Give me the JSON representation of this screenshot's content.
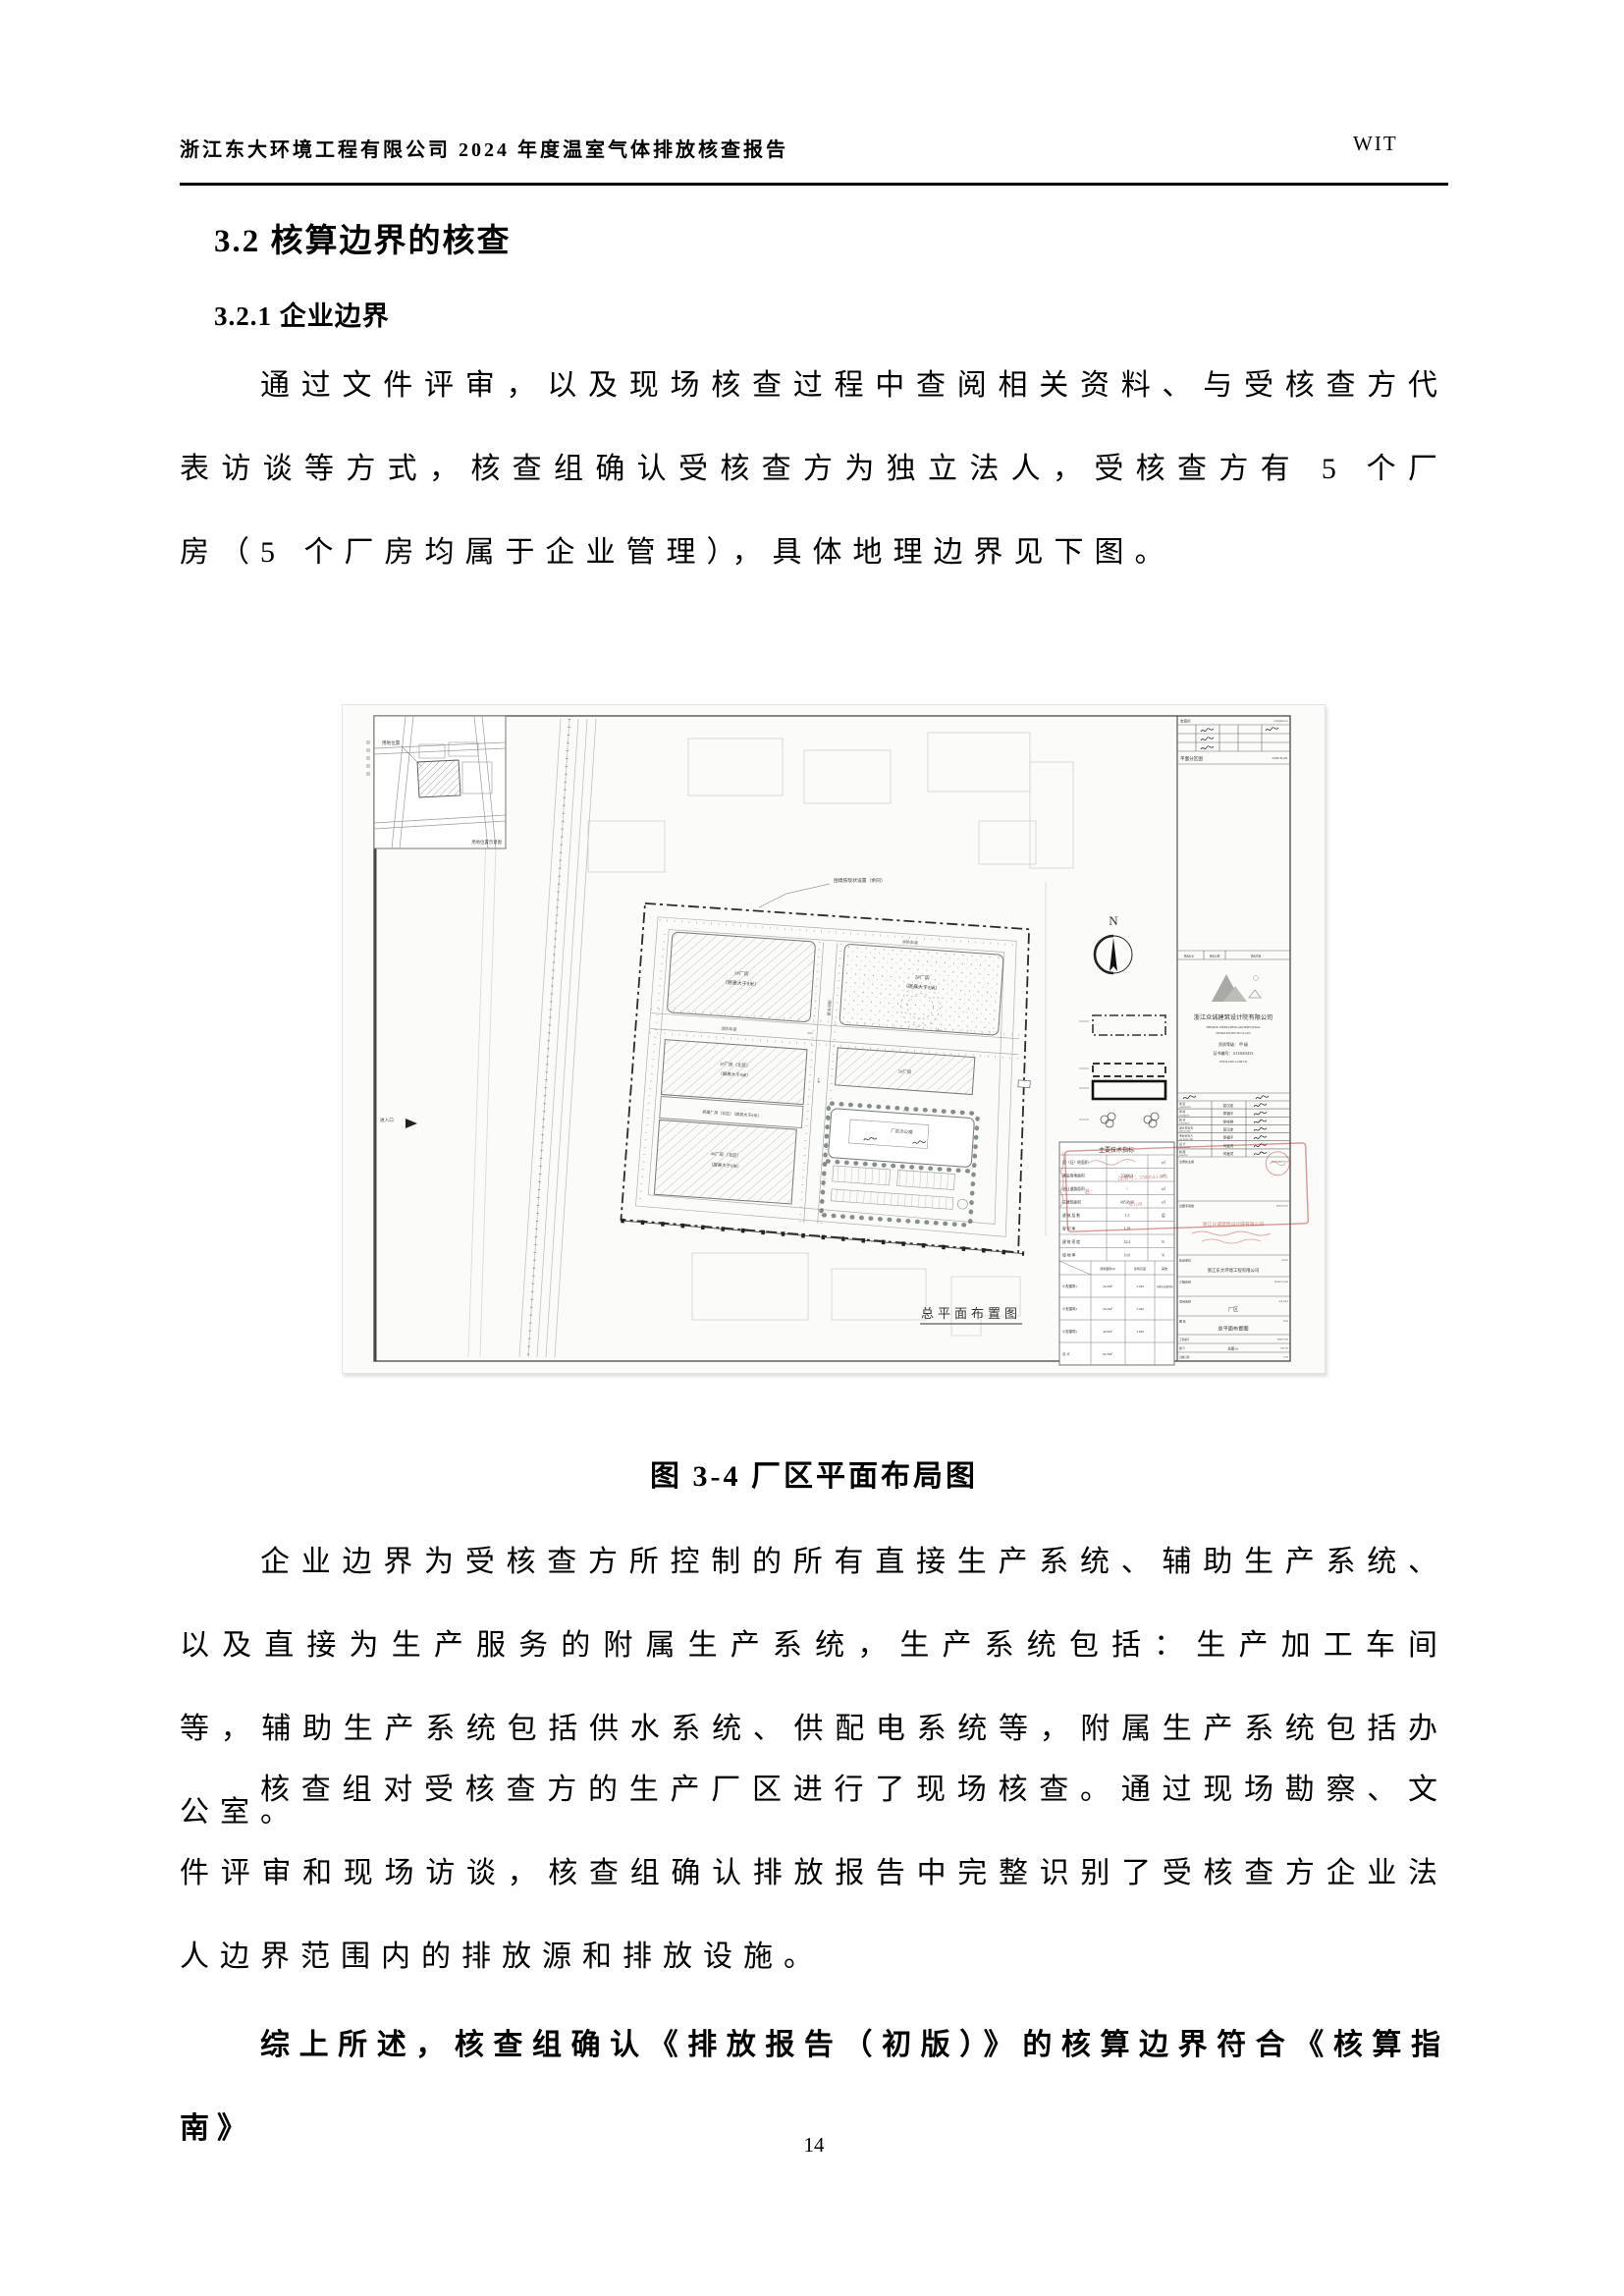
{
  "header": {
    "left": "浙江东大环境工程有限公司 2024 年度温室气体排放核查报告",
    "right": "WIT"
  },
  "headings": {
    "section": "3.2 核算边界的核查",
    "subsection": "3.2.1 企业边界"
  },
  "paragraphs": {
    "p1": "通过文件评审，以及现场核查过程中查阅相关资料、与受核查方代表访谈等方式，核查组确认受核查方为独立法人，受核查方有 5 个厂房（5 个厂房均属于企业管理），具体地理边界见下图。",
    "p2": "企业边界为受核查方所控制的所有直接生产系统、辅助生产系统、以及直接为生产服务的附属生产系统，生产系统包括：生产加工车间等，辅助生产系统包括供水系统、供配电系统等，附属生产系统包括办公室。",
    "p3": "核查组对受核查方的生产厂区进行了现场核查。通过现场勘察、文件评审和现场访谈，核查组确认排放报告中完整识别了受核查方企业法人边界范围内的排放源和排放设施。",
    "p4": "综上所述，核查组确认《排放报告（初版）》的核算边界符合《核算指南》"
  },
  "figure_caption": "图 3-4 厂区平面布局图",
  "page_number": "14",
  "colors": {
    "stamp_red": "#b0332b",
    "boundary": "#2b2b2b"
  },
  "figure": {
    "plan_label": "总平面布置图",
    "north": "N",
    "inset": {
      "pointer_label": "用地位置",
      "caption": "用地位置示意图"
    },
    "notes": {
      "fence": "围墙按现状设置（余同）",
      "entrance": "进入口"
    },
    "road_label": "消防车道",
    "dims": [
      "4.00",
      "54.50",
      "6.00",
      "52.24"
    ],
    "buildings": {
      "b1": [
        "1#厂房",
        "（层高大于8米）"
      ],
      "b2": [
        "2#厂房",
        "（层高大于8米）"
      ],
      "b3": [
        "3#厂房（北区）",
        "（层高大于8米）"
      ],
      "demolish": "拆建厂房（北区）（层高大于8米）",
      "b4": [
        "4#厂房（北区）",
        "（层高大于8米）"
      ],
      "b5": "5#厂房",
      "office": "厂区办公楼"
    },
    "title_block": {
      "sign_bar": "会签栏",
      "sign_bar_en": "CONFIRMED BY",
      "zone_plan": "平面分区图",
      "zone_plan_en": "ZONE PLAN",
      "revision": [
        "修改标记",
        "修改日期",
        "修改内容"
      ],
      "company": "浙江众诚建筑设计院有限公司",
      "company_en1": "ZHEJIANG ZHONGCHENG ARCHITECTURAL",
      "company_en2": "DESIGN INSTITUTE CO.,LTD",
      "grade": "资质等级： 甲 级",
      "cert": "证书编号：A133003433",
      "site": "WWW.ZJZC.COM.CN",
      "rows": [
        {
          "cn": "审 定",
          "en": "APPROVED BY",
          "name": "葛汉定"
        },
        {
          "cn": "审 核",
          "en": "VERIFIED BY",
          "name": "章福平"
        },
        {
          "cn": "校 对",
          "en": "CHECKED BY",
          "name": "徐祥艳"
        },
        {
          "cn": "设计总负责",
          "en": "DESIGN CHIEF",
          "name": "葛汉定"
        },
        {
          "cn": "专业负责人",
          "en": "DISCIPLINE CHIEF",
          "name": "章福平"
        },
        {
          "cn": "设 计",
          "en": "DESIGNED BY",
          "name": "何鑫灵"
        },
        {
          "cn": "制 图",
          "en": "DRAWN BY",
          "name": "何鑫灵"
        }
      ],
      "reg_seal": "注册执业章",
      "reg_seal_en": "REGISTERED SEAL",
      "out_seal": "出图专用章",
      "out_seal_en": "DESIGN SEAL",
      "client_label": "建设单位",
      "client_en": "CLIENT",
      "client": "浙江东大环境工程有限公司",
      "project_label": "工程名称",
      "project_en": "PROJECT NAME",
      "sub_label": "项目名称",
      "sub_en": "SUB TITLE",
      "sub_value": "厂区",
      "title_label": "图 名",
      "title_en": "TITLE",
      "title_value": "总平面布置图",
      "no_label": "工程编号",
      "no_en": "PROJECT NO",
      "dwg_label": "图 号",
      "dwg_en": "DWG NO",
      "dwg_value": "总图-01",
      "date_label": "出图日期",
      "date_en": "DATE"
    },
    "tech_table": {
      "title": "主要技术指标",
      "rows": [
        {
          "label": "用（征）地面积",
          "value": "/",
          "unit": "㎡"
        },
        {
          "label": "建设用地面积",
          "value": "53206.3",
          "unit": "㎡"
        },
        {
          "label": "退让道路面积",
          "value": "/",
          "unit": "㎡"
        },
        {
          "label": "总建筑面积",
          "value": "40538.90",
          "unit": "㎡"
        },
        {
          "label": "建 筑 层 数",
          "value": "1.5",
          "unit": "层"
        },
        {
          "label": "容 积 率",
          "value": "1.29",
          "unit": ""
        },
        {
          "label": "建 筑 密 度",
          "value": "42.4",
          "unit": "%"
        },
        {
          "label": "绿 地 率",
          "value": "10.0",
          "unit": "%"
        }
      ],
      "sub_headers": [
        "建筑面积M²",
        "建筑高度",
        "其他"
      ],
      "sub_rows": [
        {
          "label": "小型建筑1",
          "area": "26.2M²",
          "height": "3.0M",
          "other": "功能为设备用房"
        },
        {
          "label": "小型建筑2",
          "area": "26.2M²",
          "height": "3.9M",
          "other": ""
        },
        {
          "label": "小型建筑3",
          "area": "42.6M²",
          "height": "3.9M",
          "other": ""
        },
        {
          "label": "合 计",
          "area": "94.3M²",
          "height": "",
          "other": ""
        }
      ]
    },
    "stamps": {
      "name_label": "名：",
      "reg_no": "注册号：3300543-013",
      "date_frag": "年12月",
      "company_red": "浙江众诚建筑设计院有限公司"
    }
  }
}
